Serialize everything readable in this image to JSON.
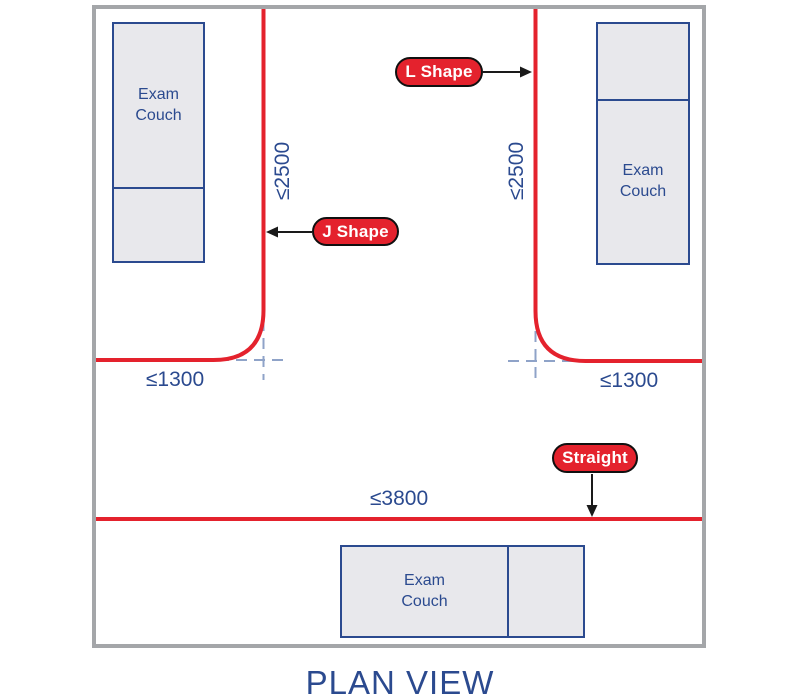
{
  "colors": {
    "track_red": "#e4222d",
    "navy": "#2b4a8f",
    "couch_fill": "#e8e8ec",
    "frame_gray": "#a4a6a9",
    "dash_blue": "#8fa3c8",
    "arrow_black": "#1a1a1a",
    "pill_text": "#ffffff"
  },
  "tracks": {
    "l_shape": {
      "label": "L Shape",
      "vertical_dim": "≤2500",
      "horizontal_dim": "≤1300"
    },
    "j_shape": {
      "label": "J Shape",
      "vertical_dim": "≤2500",
      "horizontal_dim": "≤1300"
    },
    "straight": {
      "label": "Straight",
      "length_dim": "≤3800"
    }
  },
  "couches": {
    "top_left": {
      "label": "Exam Couch"
    },
    "top_right": {
      "label": "Exam Couch"
    },
    "bottom": {
      "label": "Exam Couch"
    }
  },
  "footer": {
    "title": "PLAN VIEW"
  }
}
